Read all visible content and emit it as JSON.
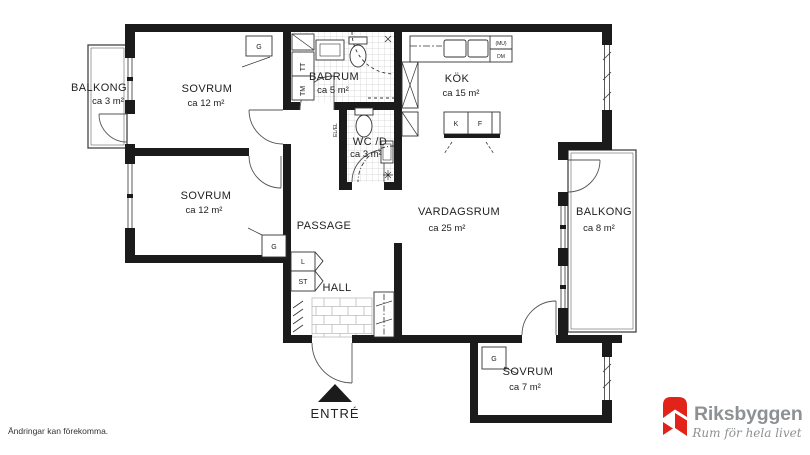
{
  "page": {
    "disclaimer": "Ändringar kan förekomma."
  },
  "brand": {
    "name": "Riksbyggen",
    "tagline": "Rum för hela livet",
    "logo_red": "#E2231A",
    "logo_gray": "#8E9193"
  },
  "plan": {
    "ink": "#1b1b1b",
    "rooms": [
      {
        "id": "balkong-left",
        "name": "BALKONG",
        "area": "ca 3 m²"
      },
      {
        "id": "sovrum-1",
        "name": "SOVRUM",
        "area": "ca 12 m²"
      },
      {
        "id": "badrum",
        "name": "BADRUM",
        "area": "ca 5 m²"
      },
      {
        "id": "kok",
        "name": "KÖK",
        "area": "ca 15 m²"
      },
      {
        "id": "sovrum-2",
        "name": "SOVRUM",
        "area": "ca 12 m²"
      },
      {
        "id": "wc-d",
        "name": "WC /D",
        "area": "ca 3 m²"
      },
      {
        "id": "passage",
        "name": "PASSAGE",
        "area": ""
      },
      {
        "id": "vardagsrum",
        "name": "VARDAGSRUM",
        "area": "ca 25 m²"
      },
      {
        "id": "balkong-right",
        "name": "BALKONG",
        "area": "ca 8 m²"
      },
      {
        "id": "hall",
        "name": "HALL",
        "area": ""
      },
      {
        "id": "sovrum-3",
        "name": "SOVRUM",
        "area": "ca 7 m²"
      }
    ],
    "entry_label": "ENTRÉ",
    "fixtures": {
      "g1": "G",
      "g2": "G",
      "g3": "G",
      "l": "L",
      "st": "ST",
      "tt": "TT",
      "tm": "TM",
      "k": "K",
      "f": "F",
      "mu": "(MU)",
      "dm": "DM",
      "el": "EL/EL"
    }
  }
}
